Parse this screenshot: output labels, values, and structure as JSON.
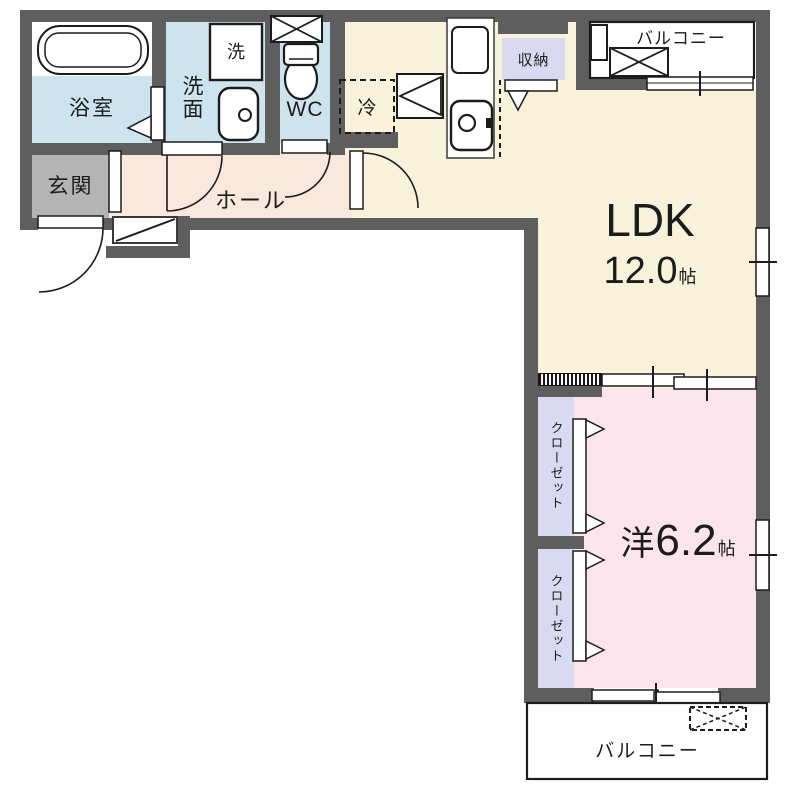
{
  "plan_title": "apartment-floor-plan",
  "colors": {
    "wall": "#5e5e5e",
    "wet_area": "#cde4ef",
    "hall": "#fbe8dc",
    "entrance": "#b4b4b4",
    "ldk": "#f8f2da",
    "western_room": "#fce4ec",
    "closet": "#d9daf1",
    "balcony": "#ffffff",
    "line": "#1c1c1c"
  },
  "rooms": {
    "bathroom": {
      "name": "浴室"
    },
    "washroom": {
      "name": "洗面"
    },
    "washer": {
      "name": "洗"
    },
    "toilet": {
      "name": "WC"
    },
    "entrance": {
      "name": "玄関"
    },
    "hall": {
      "name": "ホール"
    },
    "refrigerator": {
      "name": "冷"
    },
    "storage": {
      "name": "収納"
    },
    "ldk": {
      "name": "LDK",
      "size": "12.0",
      "unit": "帖"
    },
    "western_room": {
      "name": "洋",
      "size": "6.2",
      "unit": "帖"
    },
    "closet_upper": {
      "name": "クローゼット"
    },
    "closet_lower": {
      "name": "クローゼット"
    },
    "balcony_north": {
      "name": "バルコニー"
    },
    "balcony_south": {
      "name": "バルコニー"
    }
  }
}
